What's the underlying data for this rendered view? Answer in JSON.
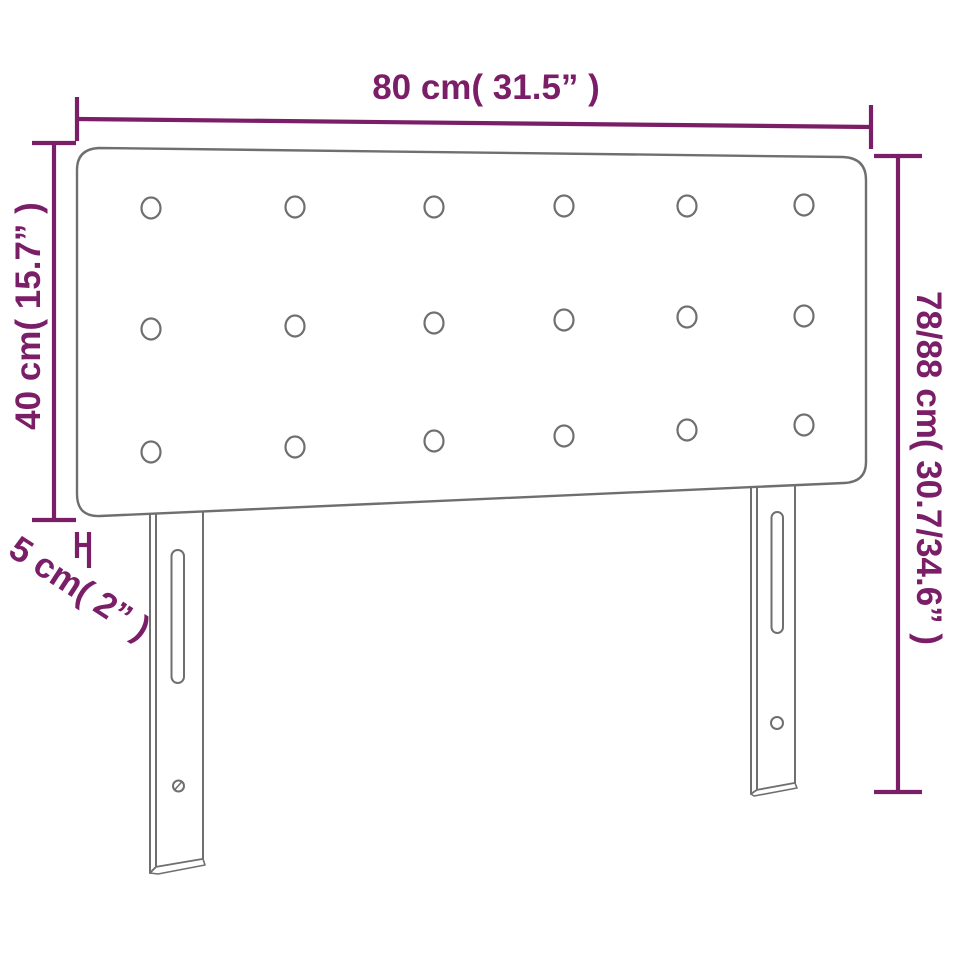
{
  "diagram": {
    "type": "furniture-dimension-diagram",
    "subject": "upholstered headboard with two mounting legs",
    "labels": {
      "width_top": "80 cm( 31.5” )",
      "height_left": "40 cm( 15.7” )",
      "thickness": "5 cm( 2” )",
      "height_right": "78/88 cm( 30.7/34.6” )"
    },
    "button_grid": {
      "rows": 3,
      "columns": 6,
      "count": 18
    },
    "legs": {
      "count": 2,
      "features": [
        "adjustment-slot",
        "screw-hole"
      ]
    },
    "colors": {
      "dimension_accent": "#7b1e68",
      "outline_gray": "#6f6f6f",
      "background": "#ffffff"
    }
  }
}
